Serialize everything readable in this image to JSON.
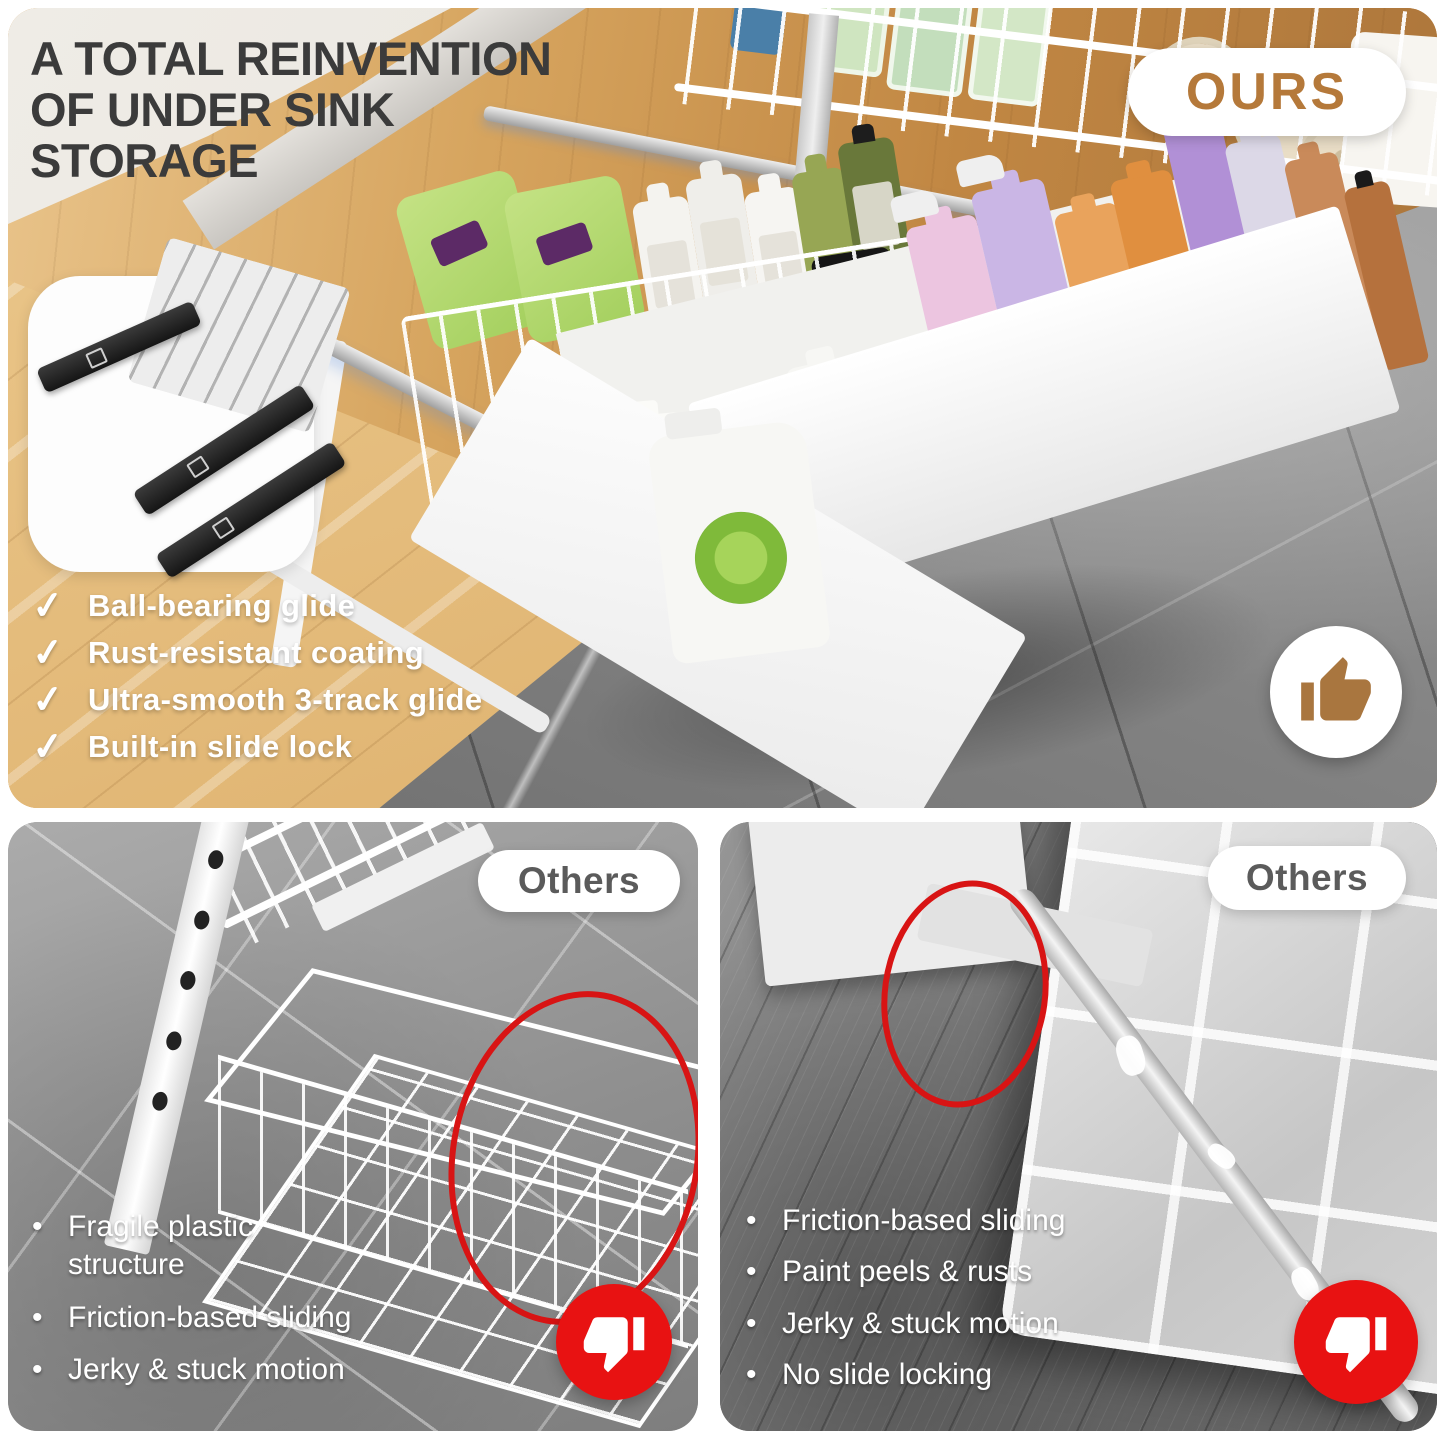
{
  "header": {
    "title_lines": [
      "A TOTAL REINVENTION",
      "OF UNDER SINK",
      "STORAGE"
    ],
    "ours_badge": "OURS"
  },
  "ours": {
    "features": [
      "Ball-bearing glide",
      "Rust-resistant coating",
      "Ultra-smooth 3-track glide",
      "Built-in slide lock"
    ]
  },
  "others_left": {
    "badge": "Others",
    "bullets": [
      "Fragile plastic structure",
      "Friction-based sliding",
      "Jerky & stuck motion"
    ]
  },
  "others_right": {
    "badge": "Others",
    "bullets": [
      "Friction-based sliding",
      "Paint peels & rusts",
      "Jerky & stuck motion",
      "No slide locking"
    ]
  },
  "glyphs": {
    "check": "✓",
    "bullet": "•"
  },
  "colors": {
    "brand_brown": "#b5793a",
    "alert_red": "#e21212",
    "title_gray": "#3b3b3b",
    "badge_text_gray": "#5b5b5b"
  }
}
